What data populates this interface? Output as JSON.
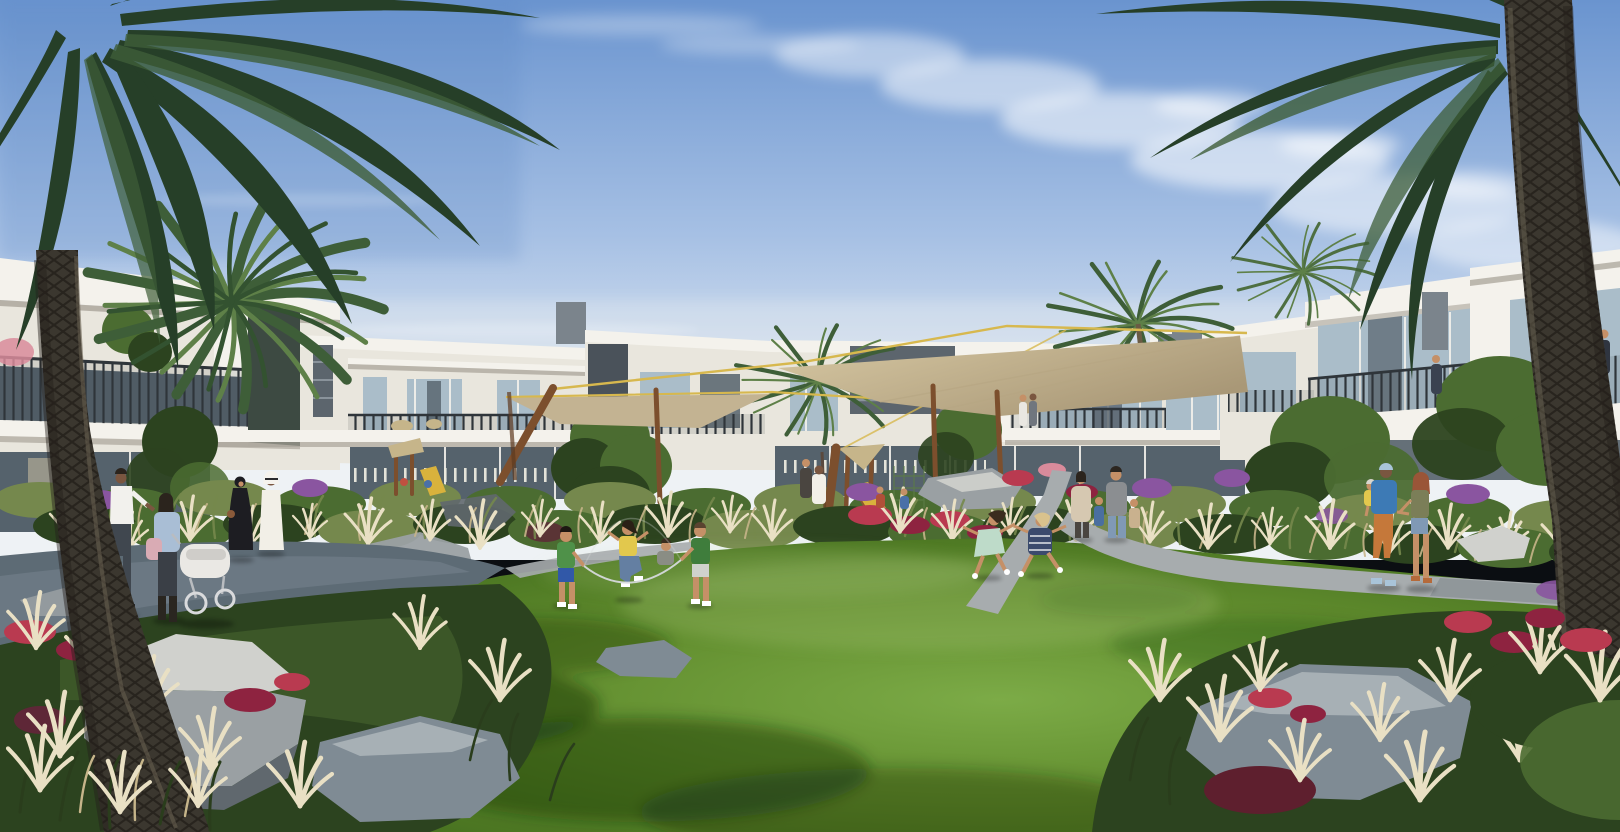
{
  "scene": {
    "description": "Sunny architectural rendering of a modern white townhouse community framed by two large foreground palm trees. Families relax on a central green lawn: children jump rope and run, couples stroll on curved grey walkways, and tan shade sails on timber masts cover a playground amid beds of ornamental plume grasses, boulders and red and purple flowers under a blue sky with wispy clouds.",
    "setting": "residential community courtyard, daytime",
    "palette": {
      "sky_top": "#6a94cf",
      "sky_mid": "#a6c0e4",
      "sky_horizon": "#eef2f5",
      "cloud_white": "#ffffff",
      "building_white": "#f4f2ec",
      "building_cream": "#e9e6dd",
      "building_shade": "#d8d4ca",
      "fascia_shadow": "#a9a49a",
      "dark_panel": "#4a525a",
      "mid_panel": "#7b848c",
      "louver_grey": "#5c656d",
      "glass_blue": "#aabdc9",
      "glass_dark": "#55626c",
      "railing_dark": "#2f353a",
      "sail_light": "#d8c9a4",
      "sail_dark": "#a99877",
      "cable_yellow": "#d7b84e",
      "wood_post": "#7c4f2d",
      "wood_dark": "#5e3a20",
      "palm_dark": "#263f28",
      "palm_mid": "#3e5e38",
      "palm_light": "#5e8048",
      "trunk_dark": "#3b372f",
      "trunk_light": "#655e4f",
      "lawn_bright": "#7cab47",
      "lawn_mid": "#618d2e",
      "lawn_deep": "#46701f",
      "lawn_shadow": "#2c4a17",
      "path_sun": "#a7acae",
      "path_shade": "#5d6b75",
      "grass_olive": "#75884d",
      "grass_tan": "#c6b58a",
      "plume_cream": "#e9e0c4",
      "foliage_dark": "#2c431f",
      "foliage_mid": "#4b6c31",
      "flower_red": "#b93a50",
      "flower_crimson": "#8e2340",
      "flower_purple": "#8a55a0",
      "flower_pink": "#d98b9b",
      "rock_light": "#d0d1cd",
      "rock_mid": "#9aa0a3",
      "rock_dark": "#60686e",
      "rock_blue": "#7f8b94",
      "skin": "#c59067",
      "skin_dark": "#7a5640",
      "kandura_white": "#f2efe7",
      "abaya_black": "#1d1d22",
      "shirt_blue": "#a9bed5",
      "tote_pink": "#d9abb4",
      "tee_white": "#f2f1ed",
      "jeans_dark": "#40474f",
      "top_yellow": "#e2c84d",
      "jeans_blue": "#647fa2",
      "tee_green": "#4f9149",
      "dress_mint": "#bedbc9",
      "dress_navy": "#3b4a6d",
      "cardigan_beige": "#d6c8b1",
      "tee_grey": "#8b8e91",
      "tee_blue": "#3d7ab5",
      "pants_orange": "#c5783a",
      "top_olive": "#7b7e58",
      "shorts_denim": "#8099b5",
      "hair_dark": "#2b241d",
      "hair_auburn": "#9a5538",
      "hair_blonde": "#d9c28d",
      "stroller_white": "#eae8e4"
    },
    "objects": [
      {
        "name": "sky",
        "note": "blue gradient, wispy cirrus and small puffy clouds upper right"
      },
      {
        "name": "townhouse-row",
        "note": "flat-roofed white two-storey townhouses with dark grey accent panels, glass balconies with dark metal railings, floor-to-ceiling glazing"
      },
      {
        "name": "shade-sails",
        "note": "tan fabric sails on tilted timber masts with yellow tension cables over playground"
      },
      {
        "name": "playground",
        "note": "timber frame, yellow slide, climbing net, straw canopies"
      },
      {
        "name": "central-lawn",
        "note": "large sunlit green lawn with dappled tree shadows"
      },
      {
        "name": "walkways",
        "note": "curved grey concrete paths, shaded on the left, sunlit right"
      },
      {
        "name": "planting-beds",
        "note": "ornamental plume grasses, olive shrubs, red and crimson flowers, purple bougainvillea, grey boulders"
      },
      {
        "name": "foreground-palms",
        "note": "large date palms framing top-left and top-right with textured leaning trunks"
      },
      {
        "name": "background-palms",
        "note": "smaller palm crowns rising behind rooflines"
      }
    ],
    "people": [
      {
        "name": "man-with-stroller",
        "note": "white t-shirt, dark jeans, left walkway"
      },
      {
        "name": "woman-with-stroller",
        "note": "light blue shirt, pink tote, pushing white pram"
      },
      {
        "name": "woman-in-abaya",
        "note": "black abaya, left walkway"
      },
      {
        "name": "man-in-kandura",
        "note": "white kandura and ghutra, left walkway"
      },
      {
        "name": "jump-rope-children",
        "note": "four kids playing jump rope on lawn"
      },
      {
        "name": "running-girls",
        "note": "girl in mint dress and girl in navy striped dress running"
      },
      {
        "name": "family-walking-away",
        "note": "parents with two children on centre path"
      },
      {
        "name": "family-right-path",
        "note": "father in blue tee and orange trousers carrying toddler, mother in olive top and denim shorts"
      },
      {
        "name": "playground-figures",
        "note": "adults and small children at play structure"
      },
      {
        "name": "balcony-residents",
        "note": "tiny figures on balconies of centre and right blocks"
      }
    ]
  }
}
